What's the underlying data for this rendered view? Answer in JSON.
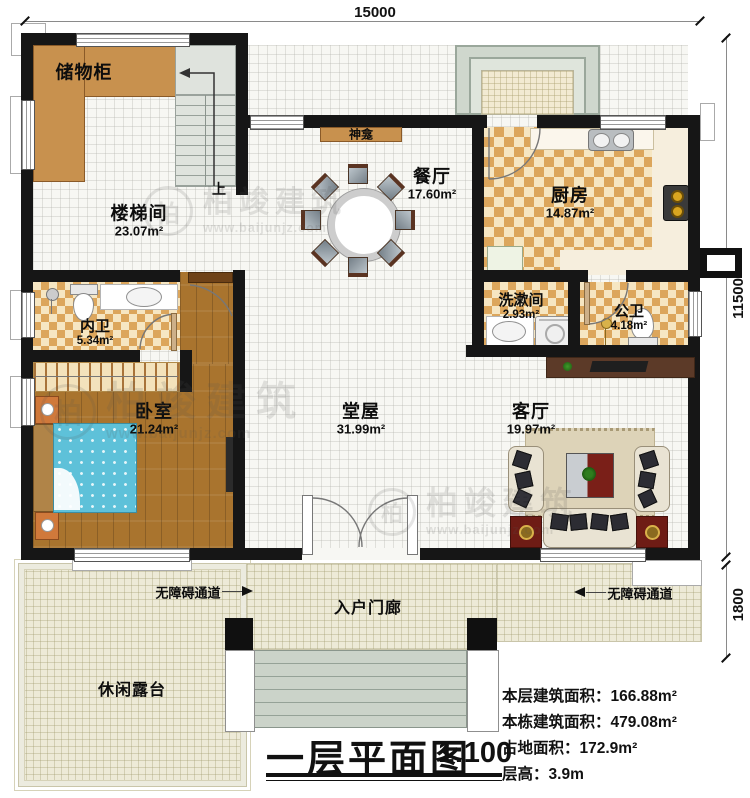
{
  "title_block": {
    "title": "一层平面图",
    "scale": "1:100"
  },
  "stats": [
    {
      "label": "本层建筑面积：",
      "value": "166.88m²"
    },
    {
      "label": "本栋建筑面积：",
      "value": "479.08m²"
    },
    {
      "label": "占地面积：",
      "value": "172.9m²"
    },
    {
      "label": "层高：",
      "value": "3.9m"
    }
  ],
  "dimensions": {
    "top": "15000",
    "right": "11500",
    "right_lower": "1800"
  },
  "rooms": {
    "storage": {
      "name": "储物柜"
    },
    "stairwell": {
      "name": "楼梯间",
      "area": "23.07m²"
    },
    "dining": {
      "name": "餐厅",
      "area": "17.60m²"
    },
    "kitchen": {
      "name": "厨房",
      "area": "14.87m²"
    },
    "washroom": {
      "name": "洗漱间",
      "area": "2.93m²"
    },
    "public_bath": {
      "name": "公卫",
      "area": "4.18m²"
    },
    "private_bath": {
      "name": "内卫",
      "area": "5.34m²"
    },
    "bedroom": {
      "name": "卧室",
      "area": "21.24m²"
    },
    "main_hall": {
      "name": "堂屋",
      "area": "31.99m²"
    },
    "living": {
      "name": "客厅",
      "area": "19.97m²"
    },
    "porch": {
      "name": "入户门廊"
    },
    "terrace": {
      "name": "休闲露台"
    }
  },
  "annotations": {
    "shrine": "神龛",
    "stairs_up": "上",
    "accessible_path": "无障碍通道"
  },
  "watermark": {
    "logo": "柏",
    "brand": "柏竣建筑",
    "url": "www.baijunjz.com"
  },
  "colors": {
    "wall": "#161616",
    "storage_wood": "#c8914e",
    "kitchen_checker": "#dca65c",
    "bedroom_plank": "#a9742e",
    "terrace": "#edead7",
    "bed_blue": "#5ec1d9",
    "accent_red": "#7a1f18",
    "cabinet_brown": "#5c3a28"
  }
}
